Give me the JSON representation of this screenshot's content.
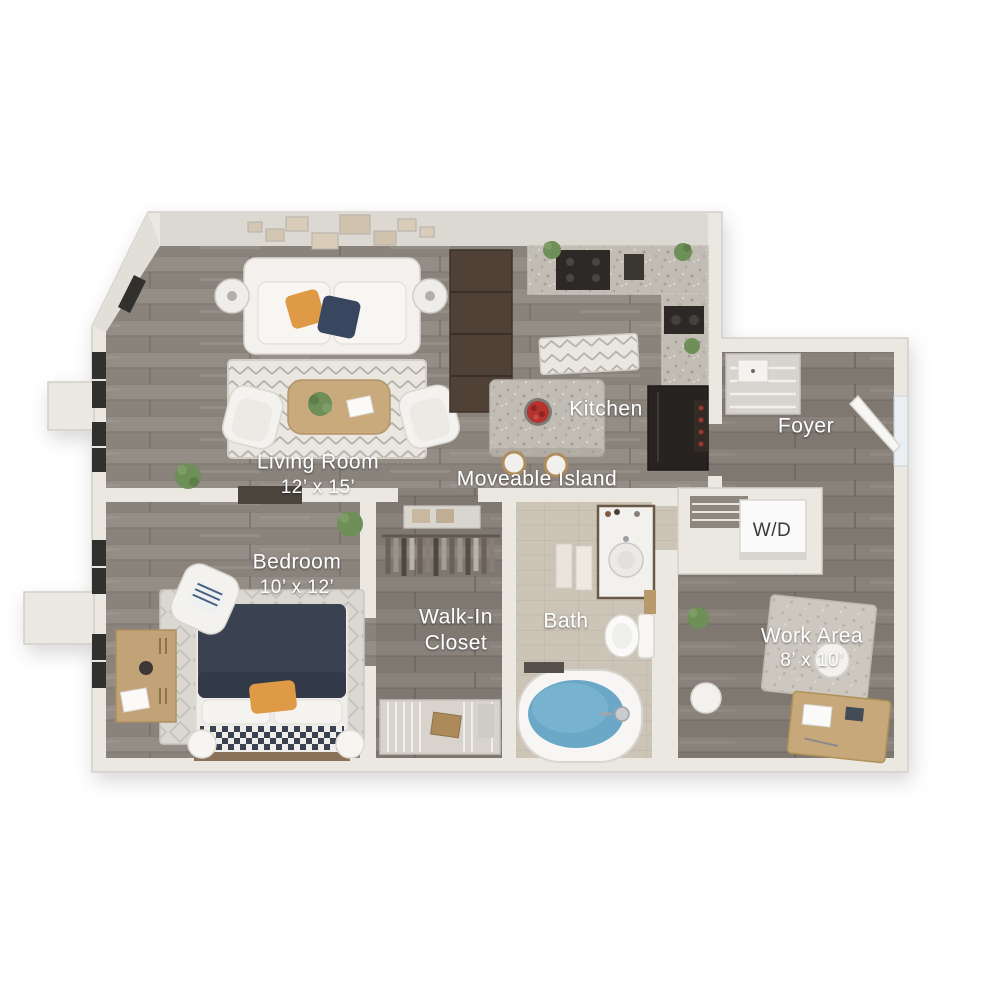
{
  "image_type": "3d-isometric-floor-plan",
  "background": "#ffffff",
  "rooms": [
    {
      "id": "living-room",
      "label": "Living Room",
      "dimensions": "12’ x 15’"
    },
    {
      "id": "kitchen",
      "label": "Kitchen",
      "dimensions": ""
    },
    {
      "id": "moveable-island",
      "label": "Moveable Island",
      "dimensions": ""
    },
    {
      "id": "foyer",
      "label": "Foyer",
      "dimensions": ""
    },
    {
      "id": "bedroom",
      "label": "Bedroom",
      "dimensions": "10’ x 12’"
    },
    {
      "id": "walk-in-closet",
      "label": "Walk-In Closet",
      "label_line1": "Walk-In",
      "label_line2": "Closet",
      "dimensions": ""
    },
    {
      "id": "bath",
      "label": "Bath",
      "dimensions": ""
    },
    {
      "id": "washer-dryer",
      "label": "W/D",
      "dimensions": ""
    },
    {
      "id": "work-area",
      "label": "Work Area",
      "dimensions": "8’ x 10’"
    }
  ],
  "colors": {
    "wall_cream": "#ebe8e2",
    "wall_face_shadow": "#d9d5cf",
    "wall_outline": "#d2cec7",
    "floor_wood": "#8e8882",
    "floor_wood_dark": "#837d76",
    "bath_tile": "#cbc4b7",
    "granite_counter": "#c2bdb4",
    "cabinet_dark_brown": "#4f4136",
    "appliance_black": "#2a2724",
    "bed_navy": "#3a4150",
    "pillow_orange": "#df9a45",
    "pillow_navy": "#394660",
    "tub_water": "#6ba8c7",
    "rug_light": "#eae7e1",
    "wood_furniture": "#c6a87a",
    "plant_green": "#6e8f58",
    "flower_red": "#b5322e",
    "label_text": "#fdfdfd",
    "wd_text": "#3a3a3a"
  }
}
